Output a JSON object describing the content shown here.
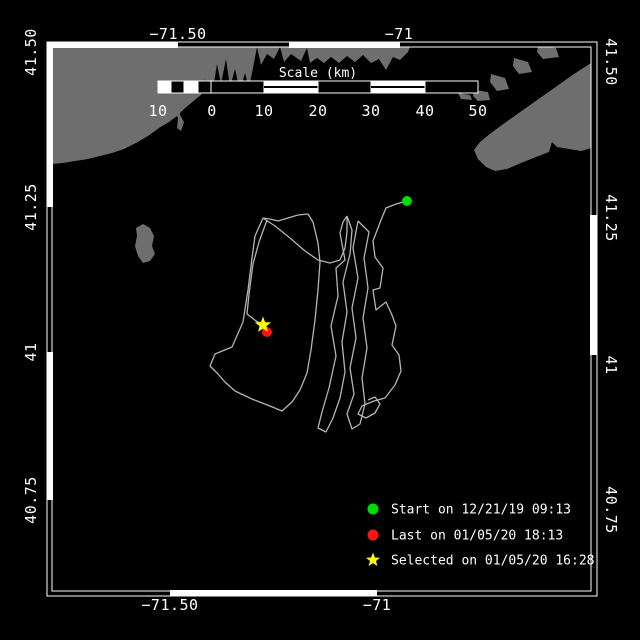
{
  "window": {
    "width": 640,
    "height": 640,
    "background": "#000000"
  },
  "colors": {
    "land": "#6e6e6e",
    "sea": "#000000",
    "track": "#b4b4b4",
    "frame": "#ffffff",
    "text": "#ffffff",
    "start": "#00dd00",
    "last": "#ff1212",
    "selected": "#ffff00"
  },
  "axis_labels": {
    "top": [
      {
        "text": "−71.50",
        "x": 178,
        "y": 39
      },
      {
        "text": "−71",
        "x": 399,
        "y": 39
      }
    ],
    "bottom": [
      {
        "text": "−71.50",
        "x": 170,
        "y": 610
      },
      {
        "text": "−71",
        "x": 377,
        "y": 610
      }
    ],
    "left": [
      {
        "text": "41.50",
        "x": 36,
        "y": 52
      },
      {
        "text": "41.25",
        "x": 36,
        "y": 207
      },
      {
        "text": "41",
        "x": 36,
        "y": 352
      },
      {
        "text": "40.75",
        "x": 36,
        "y": 500
      }
    ],
    "right": [
      {
        "text": "41.50",
        "x": 606,
        "y": 62
      },
      {
        "text": "41.25",
        "x": 606,
        "y": 218
      },
      {
        "text": "41",
        "x": 606,
        "y": 365
      },
      {
        "text": "40.75",
        "x": 606,
        "y": 510
      }
    ]
  },
  "frame": {
    "outer": [
      47,
      42,
      597,
      596
    ],
    "inner": [
      52,
      47,
      591,
      591
    ],
    "bands": {
      "top": [
        [
          47,
          178,
          "w"
        ],
        [
          178,
          289,
          "b"
        ],
        [
          289,
          400,
          "w"
        ],
        [
          400,
          597,
          "b"
        ]
      ],
      "bottom": [
        [
          47,
          170,
          "b"
        ],
        [
          170,
          377,
          "w"
        ],
        [
          377,
          597,
          "b"
        ]
      ],
      "left": [
        [
          42,
          207,
          "w"
        ],
        [
          207,
          352,
          "b"
        ],
        [
          352,
          500,
          "w"
        ],
        [
          500,
          596,
          "b"
        ]
      ],
      "right": [
        [
          42,
          215,
          "b"
        ],
        [
          215,
          355,
          "w"
        ],
        [
          355,
          596,
          "b"
        ]
      ]
    }
  },
  "scale_bar": {
    "title": "Scale (km)",
    "title_x": 318,
    "title_y": 77,
    "bar": {
      "x": 158,
      "y": 81,
      "height": 12
    },
    "segments": [
      [
        158,
        171,
        "w"
      ],
      [
        171,
        184,
        "b"
      ],
      [
        184,
        198,
        "w"
      ],
      [
        198,
        211,
        "b"
      ],
      [
        211,
        264,
        "b"
      ],
      [
        264,
        318,
        "s"
      ],
      [
        318,
        371,
        "b"
      ],
      [
        371,
        425,
        "s"
      ],
      [
        425,
        478,
        "b"
      ]
    ],
    "labels": [
      {
        "text": "10",
        "x": 158
      },
      {
        "text": "0",
        "x": 212
      },
      {
        "text": "10",
        "x": 264
      },
      {
        "text": "20",
        "x": 318
      },
      {
        "text": "30",
        "x": 371
      },
      {
        "text": "40",
        "x": 425
      },
      {
        "text": "50",
        "x": 478
      }
    ],
    "label_y": 116
  },
  "markers": {
    "start": {
      "x": 407,
      "y": 201,
      "r": 5
    },
    "last": {
      "x": 267,
      "y": 332,
      "r": 5
    },
    "selected": {
      "x": 263,
      "y": 325,
      "r": 8.5
    }
  },
  "legend": {
    "marker_x": 373,
    "text_x": 391,
    "items": [
      {
        "marker": "circle",
        "color_key": "start",
        "y": 509,
        "label": "Start on 12/21/19 09:13"
      },
      {
        "marker": "circle",
        "color_key": "last",
        "y": 535,
        "label": "Last on 01/05/20 18:13"
      },
      {
        "marker": "star",
        "color_key": "selected",
        "y": 560,
        "label": "Selected on 01/05/20 16:28"
      }
    ]
  },
  "land": [
    [
      [
        52,
        47
      ],
      [
        410,
        47
      ],
      [
        408,
        52
      ],
      [
        400,
        60
      ],
      [
        393,
        57
      ],
      [
        386,
        70
      ],
      [
        379,
        59
      ],
      [
        371,
        63
      ],
      [
        363,
        55
      ],
      [
        355,
        62
      ],
      [
        347,
        56
      ],
      [
        339,
        63
      ],
      [
        331,
        57
      ],
      [
        324,
        63
      ],
      [
        317,
        58
      ],
      [
        310,
        63
      ],
      [
        307,
        48
      ],
      [
        301,
        61
      ],
      [
        291,
        54
      ],
      [
        284,
        62
      ],
      [
        280,
        47
      ],
      [
        274,
        59
      ],
      [
        267,
        54
      ],
      [
        261,
        65
      ],
      [
        257,
        47
      ],
      [
        253,
        68
      ],
      [
        249,
        88
      ],
      [
        245,
        73
      ],
      [
        240,
        91
      ],
      [
        235,
        69
      ],
      [
        230,
        87
      ],
      [
        226,
        59
      ],
      [
        221,
        84
      ],
      [
        217,
        64
      ],
      [
        213,
        89
      ],
      [
        209,
        93
      ],
      [
        205,
        79
      ],
      [
        201,
        95
      ],
      [
        196,
        99
      ],
      [
        190,
        104
      ],
      [
        184,
        109
      ],
      [
        177,
        116
      ],
      [
        169,
        122
      ],
      [
        159,
        128
      ],
      [
        148,
        136
      ],
      [
        136,
        143
      ],
      [
        124,
        149
      ],
      [
        112,
        153
      ],
      [
        100,
        156
      ],
      [
        88,
        159
      ],
      [
        75,
        161
      ],
      [
        63,
        163
      ],
      [
        52,
        164
      ]
    ],
    [
      [
        176,
        103
      ],
      [
        181,
        106
      ],
      [
        180,
        115
      ],
      [
        184,
        122
      ],
      [
        181,
        131
      ],
      [
        177,
        128
      ],
      [
        178,
        118
      ],
      [
        175,
        112
      ],
      [
        176,
        103
      ]
    ],
    [
      [
        143,
        224
      ],
      [
        150,
        228
      ],
      [
        154,
        236
      ],
      [
        152,
        246
      ],
      [
        155,
        254
      ],
      [
        150,
        261
      ],
      [
        143,
        263
      ],
      [
        138,
        256
      ],
      [
        135,
        246
      ],
      [
        137,
        236
      ],
      [
        136,
        228
      ],
      [
        143,
        224
      ]
    ],
    [
      [
        458,
        93
      ],
      [
        470,
        95
      ],
      [
        472,
        100
      ],
      [
        461,
        99
      ],
      [
        458,
        93
      ]
    ],
    [
      [
        474,
        90
      ],
      [
        488,
        92
      ],
      [
        490,
        100
      ],
      [
        478,
        101
      ],
      [
        473,
        96
      ],
      [
        474,
        90
      ]
    ],
    [
      [
        491,
        74
      ],
      [
        505,
        78
      ],
      [
        509,
        89
      ],
      [
        497,
        91
      ],
      [
        490,
        82
      ],
      [
        491,
        74
      ]
    ],
    [
      [
        514,
        58
      ],
      [
        528,
        62
      ],
      [
        532,
        72
      ],
      [
        519,
        74
      ],
      [
        513,
        66
      ],
      [
        514,
        58
      ]
    ],
    [
      [
        538,
        46
      ],
      [
        556,
        48
      ],
      [
        559,
        57
      ],
      [
        543,
        59
      ],
      [
        537,
        52
      ],
      [
        538,
        46
      ]
    ],
    [
      [
        591,
        63
      ],
      [
        574,
        74
      ],
      [
        557,
        86
      ],
      [
        540,
        98
      ],
      [
        523,
        110
      ],
      [
        506,
        122
      ],
      [
        491,
        133
      ],
      [
        480,
        142
      ],
      [
        474,
        150
      ],
      [
        478,
        159
      ],
      [
        486,
        167
      ],
      [
        495,
        171
      ],
      [
        507,
        169
      ],
      [
        521,
        163
      ],
      [
        536,
        157
      ],
      [
        549,
        152
      ],
      [
        552,
        142
      ],
      [
        557,
        147
      ],
      [
        569,
        149
      ],
      [
        581,
        151
      ],
      [
        591,
        148
      ]
    ]
  ],
  "track": [
    [
      [
        407,
        201
      ],
      [
        396,
        204
      ],
      [
        386,
        208
      ],
      [
        381,
        220
      ],
      [
        373,
        241
      ],
      [
        375,
        257
      ],
      [
        383,
        268
      ],
      [
        380,
        288
      ],
      [
        373,
        290
      ],
      [
        376,
        310
      ],
      [
        386,
        302
      ],
      [
        392,
        315
      ],
      [
        396,
        326
      ],
      [
        392,
        345
      ],
      [
        399,
        355
      ],
      [
        401,
        371
      ],
      [
        395,
        385
      ],
      [
        385,
        398
      ],
      [
        374,
        401
      ],
      [
        362,
        406
      ],
      [
        358,
        414
      ],
      [
        366,
        418
      ],
      [
        375,
        413
      ],
      [
        380,
        404
      ],
      [
        375,
        397
      ],
      [
        368,
        400
      ]
    ],
    [
      [
        347,
        216
      ],
      [
        343,
        222
      ],
      [
        340,
        233
      ],
      [
        345,
        260
      ],
      [
        336,
        268
      ],
      [
        338,
        296
      ],
      [
        331,
        326
      ],
      [
        336,
        356
      ],
      [
        329,
        388
      ],
      [
        322,
        412
      ],
      [
        318,
        428
      ],
      [
        326,
        432
      ],
      [
        333,
        418
      ],
      [
        340,
        398
      ],
      [
        345,
        372
      ],
      [
        342,
        342
      ],
      [
        347,
        312
      ],
      [
        343,
        282
      ],
      [
        350,
        254
      ],
      [
        352,
        230
      ],
      [
        347,
        216
      ]
    ],
    [
      [
        358,
        221
      ],
      [
        353,
        248
      ],
      [
        358,
        278
      ],
      [
        352,
        308
      ],
      [
        356,
        338
      ],
      [
        350,
        368
      ],
      [
        354,
        394
      ],
      [
        347,
        414
      ],
      [
        352,
        429
      ],
      [
        360,
        424
      ],
      [
        365,
        404
      ],
      [
        362,
        378
      ],
      [
        367,
        348
      ],
      [
        363,
        318
      ],
      [
        368,
        288
      ],
      [
        364,
        258
      ],
      [
        369,
        232
      ],
      [
        358,
        221
      ]
    ],
    [
      [
        263,
        218
      ],
      [
        255,
        236
      ],
      [
        252,
        258
      ],
      [
        248,
        290
      ],
      [
        243,
        322
      ],
      [
        232,
        347
      ],
      [
        215,
        354
      ],
      [
        210,
        366
      ],
      [
        218,
        374
      ],
      [
        225,
        382
      ],
      [
        235,
        391
      ],
      [
        252,
        399
      ],
      [
        270,
        406
      ],
      [
        282,
        411
      ],
      [
        292,
        402
      ],
      [
        300,
        390
      ],
      [
        307,
        373
      ],
      [
        311,
        350
      ],
      [
        315,
        320
      ],
      [
        318,
        290
      ],
      [
        320,
        262
      ],
      [
        318,
        243
      ],
      [
        313,
        222
      ],
      [
        308,
        214
      ],
      [
        298,
        215
      ],
      [
        288,
        218
      ],
      [
        278,
        221
      ],
      [
        270,
        219
      ],
      [
        263,
        218
      ]
    ],
    [
      [
        263,
        218
      ],
      [
        275,
        226
      ],
      [
        290,
        238
      ],
      [
        305,
        251
      ],
      [
        318,
        260
      ],
      [
        330,
        263
      ],
      [
        340,
        260
      ],
      [
        345,
        248
      ],
      [
        347,
        232
      ],
      [
        347,
        216
      ]
    ],
    [
      [
        267,
        220
      ],
      [
        259,
        242
      ],
      [
        253,
        264
      ],
      [
        249,
        294
      ],
      [
        247,
        314
      ],
      [
        256,
        321
      ],
      [
        262,
        324
      ]
    ]
  ]
}
